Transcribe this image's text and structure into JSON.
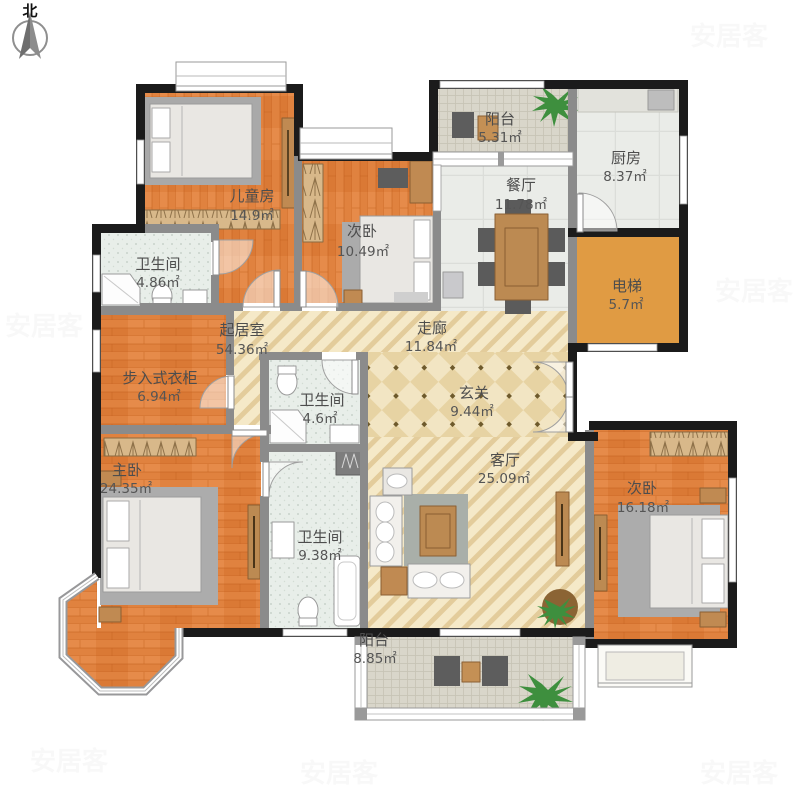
{
  "compass": {
    "label": "北"
  },
  "rooms": [
    {
      "id": "children-room",
      "name": "儿童房",
      "area": "14.9㎡"
    },
    {
      "id": "bedroom2-top",
      "name": "次卧",
      "area": "10.49㎡"
    },
    {
      "id": "balcony-top",
      "name": "阳台",
      "area": "5.31㎡"
    },
    {
      "id": "kitchen",
      "name": "厨房",
      "area": "8.37㎡"
    },
    {
      "id": "dining-room",
      "name": "餐厅",
      "area": "11.78㎡"
    },
    {
      "id": "elevator",
      "name": "电梯",
      "area": "5.7㎡"
    },
    {
      "id": "bathroom-1",
      "name": "卫生间",
      "area": "4.86㎡"
    },
    {
      "id": "family-room",
      "name": "起居室",
      "area": "54.36㎡"
    },
    {
      "id": "corridor",
      "name": "走廊",
      "area": "11.84㎡"
    },
    {
      "id": "foyer",
      "name": "玄关",
      "area": "9.44㎡"
    },
    {
      "id": "walkin-closet",
      "name": "步入式衣柜",
      "area": "6.94㎡"
    },
    {
      "id": "bathroom-2",
      "name": "卫生间",
      "area": "4.6㎡"
    },
    {
      "id": "master-bedroom",
      "name": "主卧",
      "area": "24.35㎡"
    },
    {
      "id": "living-room",
      "name": "客厅",
      "area": "25.09㎡"
    },
    {
      "id": "bathroom-3",
      "name": "卫生间",
      "area": "9.38㎡"
    },
    {
      "id": "bedroom2-right",
      "name": "次卧",
      "area": "16.18㎡"
    },
    {
      "id": "balcony-bottom",
      "name": "阳台",
      "area": "8.85㎡"
    }
  ],
  "watermark": {
    "text": "安居客"
  },
  "colors": {
    "wall_exterior": "#1b1b1b",
    "wall_interior": "#8b8b8b",
    "wood_floor": "#E0823F",
    "stripe_floor": "#F5E9C8",
    "foyer_floor": "#EDDFB3",
    "bath_tile": "#E8EEE9",
    "kitchen_tile": "#EAECE8",
    "balcony_tile": "#D9D6CA",
    "elevator_floor": "#E09B43",
    "label_text": "#4d4d4d"
  }
}
